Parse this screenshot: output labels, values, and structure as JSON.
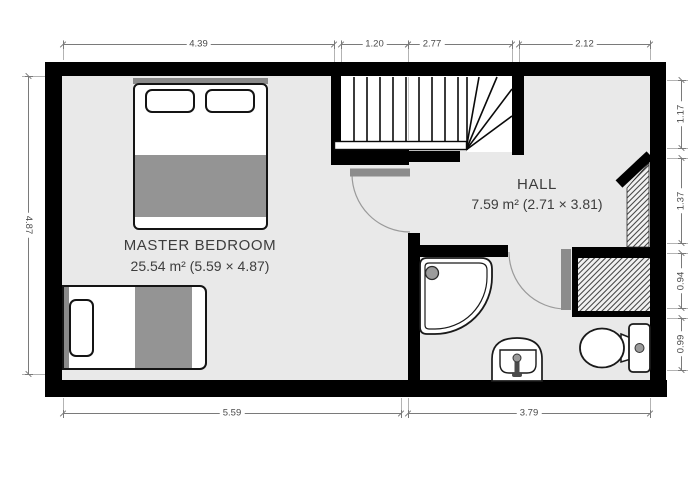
{
  "plan": {
    "type": "floor-plan",
    "rooms": {
      "master_bedroom": {
        "name": "MASTER BEDROOM",
        "area": "25.54 m² (5.59 × 4.87)"
      },
      "hall": {
        "name": "HALL",
        "area": "7.59 m² (2.71 × 3.81)"
      }
    },
    "dims": {
      "top": [
        "4.39",
        "1.20",
        "2.77",
        "2.12"
      ],
      "left": [
        "4.87"
      ],
      "right": [
        "1.17",
        "1.37",
        "0.94",
        "0.99"
      ],
      "bottom": [
        "5.59",
        "3.79"
      ]
    },
    "fixtures": [
      "staircase",
      "double-bed",
      "single-bed",
      "shower-tray",
      "washbasin",
      "toilet",
      "bedroom-door",
      "bathroom-door",
      "hatched-chimney-breast"
    ],
    "colors": {
      "wall": "#000000",
      "floor": "#e9e9e9",
      "furniture_gray": "#949494",
      "door_leaf": "#8c8c8c",
      "dimension_line": "#7a7a7a",
      "label_text": "#3d3d3d"
    }
  }
}
